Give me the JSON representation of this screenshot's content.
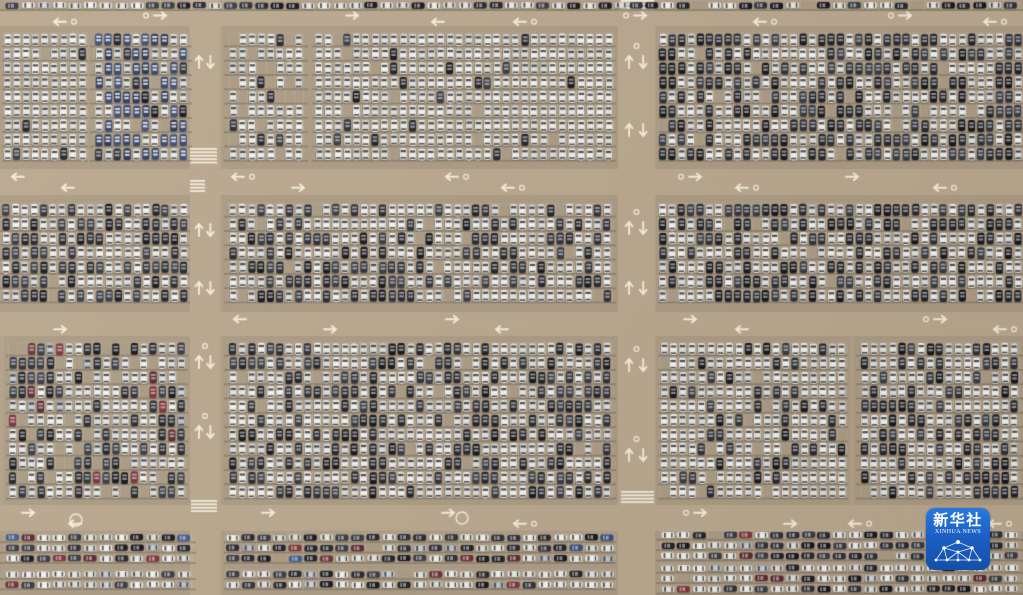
{
  "watermark": {
    "text_cn": "新华社",
    "text_en": "XINHUA NEWS",
    "bg_top": "#2a79dd",
    "bg_bottom": "#144fa8"
  },
  "scene": {
    "width": 1023,
    "height": 595,
    "palette": {
      "ground": "#b1a189",
      "lot_ground": "#ab9b84",
      "road": "#b9a88e",
      "stall_line": "rgba(255,255,255,0.16)",
      "stall_line_h": "rgba(255,255,255,0.11)",
      "row_shadow": "rgba(74,62,46,0.30)",
      "marking": "rgba(250,243,228,0.92)",
      "car_shadow": "rgba(50,42,32,0.30)",
      "windshield_on_light": "rgba(44,52,64,0.85)",
      "roof_on_dark": "rgba(218,223,228,0.60)",
      "roof_on_navy": "rgba(238,240,242,0.85)",
      "car_pools": {
        "white": [
          "#edebe4",
          "#f2f0e9",
          "#e6e4dc",
          "#dedcd4",
          "#d4d3cb"
        ],
        "dark": [
          "#23262d",
          "#2b2f37",
          "#1d2026",
          "#353a43",
          "#14161b"
        ],
        "navy": [
          "#2c3c62",
          "#33466f",
          "#263457",
          "#3b4f7a"
        ],
        "maroon": [
          "#6d2d33",
          "#7e3138",
          "#5c272e"
        ],
        "silver": [
          "#b7bac0",
          "#a9adb4",
          "#c2c5ca"
        ],
        "blue": [
          "#3a5c93",
          "#2f4f84"
        ]
      }
    },
    "car_grid": {
      "v": {
        "cw": 9.35,
        "ch": 14.3
      },
      "h": {
        "cw": 15.6,
        "ch": 10.4
      }
    },
    "roads": {
      "horizontal": [
        {
          "y": 11,
          "h": 15,
          "arrows": [
            {
              "x": 60,
              "d": "l",
              "lane": 1
            },
            {
              "x": 160,
              "d": "r",
              "lane": 0
            },
            {
              "x": 352,
              "d": "r",
              "lane": 0
            },
            {
              "x": 438,
              "d": "l",
              "lane": 1
            },
            {
              "x": 520,
              "d": "l",
              "lane": 1
            },
            {
              "x": 640,
              "d": "r",
              "lane": 0
            },
            {
              "x": 760,
              "d": "l",
              "lane": 1
            },
            {
              "x": 905,
              "d": "r",
              "lane": 0
            },
            {
              "x": 990,
              "d": "l",
              "lane": 1
            }
          ]
        },
        {
          "y": 169,
          "h": 26,
          "arrows": [
            {
              "x": 18,
              "d": "l",
              "lane": 0
            },
            {
              "x": 68,
              "d": "l",
              "lane": 1
            },
            {
              "x": 238,
              "d": "l",
              "lane": 0
            },
            {
              "x": 298,
              "d": "r",
              "lane": 1
            },
            {
              "x": 452,
              "d": "l",
              "lane": 0
            },
            {
              "x": 508,
              "d": "l",
              "lane": 1
            },
            {
              "x": 695,
              "d": "r",
              "lane": 0
            },
            {
              "x": 742,
              "d": "l",
              "lane": 1
            },
            {
              "x": 852,
              "d": "r",
              "lane": 0
            },
            {
              "x": 940,
              "d": "l",
              "lane": 1
            }
          ]
        },
        {
          "y": 312,
          "h": 24,
          "arrows": [
            {
              "x": 60,
              "d": "r",
              "lane": 1
            },
            {
              "x": 240,
              "d": "l",
              "lane": 0
            },
            {
              "x": 330,
              "d": "r",
              "lane": 1
            },
            {
              "x": 452,
              "d": "r",
              "lane": 0
            },
            {
              "x": 502,
              "d": "l",
              "lane": 1
            },
            {
              "x": 690,
              "d": "r",
              "lane": 0
            },
            {
              "x": 742,
              "d": "l",
              "lane": 1
            },
            {
              "x": 940,
              "d": "r",
              "lane": 0
            },
            {
              "x": 1000,
              "d": "l",
              "lane": 1
            }
          ]
        },
        {
          "y": 505,
          "h": 26,
          "arrows": [
            {
              "x": 28,
              "d": "r",
              "lane": 0
            },
            {
              "x": 75,
              "d": "l",
              "lane": 1
            },
            {
              "x": 268,
              "d": "r",
              "lane": 0
            },
            {
              "x": 448,
              "d": "r",
              "lane": 0
            },
            {
              "x": 520,
              "d": "l",
              "lane": 1
            },
            {
              "x": 700,
              "d": "r",
              "lane": 0
            },
            {
              "x": 790,
              "d": "r",
              "lane": 1
            },
            {
              "x": 855,
              "d": "l",
              "lane": 1
            },
            {
              "x": 995,
              "d": "l",
              "lane": 1
            }
          ]
        }
      ],
      "vertical": [
        {
          "x": 190,
          "w": 30,
          "arrows_y": [
            62,
            230,
            288,
            362,
            432
          ]
        },
        {
          "x": 618,
          "w": 37,
          "arrows_y": [
            62,
            130,
            228,
            288,
            365,
            455
          ]
        }
      ]
    },
    "crosswalks": [
      {
        "x": 190,
        "y": 148,
        "w": 27,
        "h": 18
      },
      {
        "x": 190,
        "y": 180,
        "w": 15,
        "h": 13
      },
      {
        "x": 191,
        "y": 500,
        "w": 26,
        "h": 14
      },
      {
        "x": 621,
        "y": 0,
        "w": 33,
        "h": 11
      },
      {
        "x": 621,
        "y": 491,
        "w": 33,
        "h": 13
      }
    ],
    "circles": [
      {
        "x": 76,
        "y": 520,
        "r": 6
      },
      {
        "x": 462,
        "y": 518,
        "r": 6
      }
    ],
    "blocks": [
      {
        "x": 0,
        "y": 0,
        "w": 1023,
        "h": 11,
        "o": "h",
        "d": 0.95,
        "mix": {
          "white": 0.5,
          "dark": 0.42,
          "silver": 0.08
        }
      },
      {
        "x": 2,
        "y": 27,
        "w": 86,
        "h": 140,
        "o": "v",
        "d": 0.97,
        "mix": {
          "white": 0.96,
          "dark": 0.04
        }
      },
      {
        "x": 90,
        "y": 27,
        "w": 102,
        "h": 140,
        "o": "v",
        "d": 0.97,
        "mix": {
          "navy": 0.6,
          "white": 0.32,
          "dark": 0.08
        }
      },
      {
        "x": 224,
        "y": 27,
        "w": 84,
        "h": 140,
        "o": "v",
        "d": 0.78,
        "mix": {
          "white": 0.9,
          "dark": 0.1
        }
      },
      {
        "x": 312,
        "y": 27,
        "w": 304,
        "h": 140,
        "o": "v",
        "d": 0.94,
        "mix": {
          "white": 0.94,
          "dark": 0.06
        }
      },
      {
        "x": 658,
        "y": 27,
        "w": 365,
        "h": 140,
        "o": "v",
        "d": 0.98,
        "mix": {
          "white": 0.5,
          "dark": 0.5
        }
      },
      {
        "x": 0,
        "y": 196,
        "w": 190,
        "h": 114,
        "o": "v",
        "d": 0.97,
        "mix": {
          "white": 0.52,
          "dark": 0.48
        }
      },
      {
        "x": 224,
        "y": 196,
        "w": 392,
        "h": 114,
        "o": "v",
        "d": 0.97,
        "mix": {
          "white": 0.6,
          "dark": 0.4
        }
      },
      {
        "x": 658,
        "y": 196,
        "w": 365,
        "h": 114,
        "o": "v",
        "d": 0.98,
        "mix": {
          "white": 0.52,
          "dark": 0.48
        }
      },
      {
        "x": 6,
        "y": 338,
        "w": 182,
        "h": 165,
        "o": "v",
        "d": 0.87,
        "mix": {
          "white": 0.58,
          "dark": 0.32,
          "maroon": 0.06,
          "silver": 0.04
        }
      },
      {
        "x": 224,
        "y": 338,
        "w": 392,
        "h": 165,
        "o": "v",
        "d": 0.97,
        "mix": {
          "white": 0.56,
          "dark": 0.44
        }
      },
      {
        "x": 658,
        "y": 338,
        "w": 190,
        "h": 165,
        "o": "v",
        "d": 0.96,
        "mix": {
          "white": 0.77,
          "dark": 0.23
        }
      },
      {
        "x": 856,
        "y": 338,
        "w": 167,
        "h": 165,
        "o": "v",
        "d": 0.98,
        "mix": {
          "white": 0.5,
          "dark": 0.5
        }
      },
      {
        "x": 0,
        "y": 532,
        "w": 196,
        "h": 32,
        "o": "h",
        "d": 0.97,
        "mix": {
          "white": 0.38,
          "dark": 0.4,
          "maroon": 0.12,
          "silver": 0.06,
          "blue": 0.04
        }
      },
      {
        "x": 224,
        "y": 532,
        "w": 392,
        "h": 32,
        "o": "h",
        "d": 0.97,
        "mix": {
          "white": 0.38,
          "dark": 0.4,
          "maroon": 0.12,
          "silver": 0.06,
          "blue": 0.04
        }
      },
      {
        "x": 0,
        "y": 564,
        "w": 196,
        "h": 31,
        "o": "h",
        "d": 0.97,
        "mix": {
          "white": 0.62,
          "dark": 0.24,
          "maroon": 0.08,
          "silver": 0.06
        }
      },
      {
        "x": 224,
        "y": 564,
        "w": 392,
        "h": 31,
        "o": "h",
        "d": 0.97,
        "mix": {
          "white": 0.62,
          "dark": 0.24,
          "maroon": 0.08,
          "silver": 0.06
        }
      },
      {
        "x": 656,
        "y": 529,
        "w": 367,
        "h": 33,
        "o": "h",
        "d": 0.97,
        "mix": {
          "white": 0.45,
          "dark": 0.45,
          "maroon": 0.06,
          "silver": 0.04
        }
      },
      {
        "x": 656,
        "y": 562,
        "w": 367,
        "h": 33,
        "o": "h",
        "d": 0.97,
        "mix": {
          "white": 0.6,
          "dark": 0.3,
          "maroon": 0.05,
          "silver": 0.05
        }
      }
    ]
  }
}
